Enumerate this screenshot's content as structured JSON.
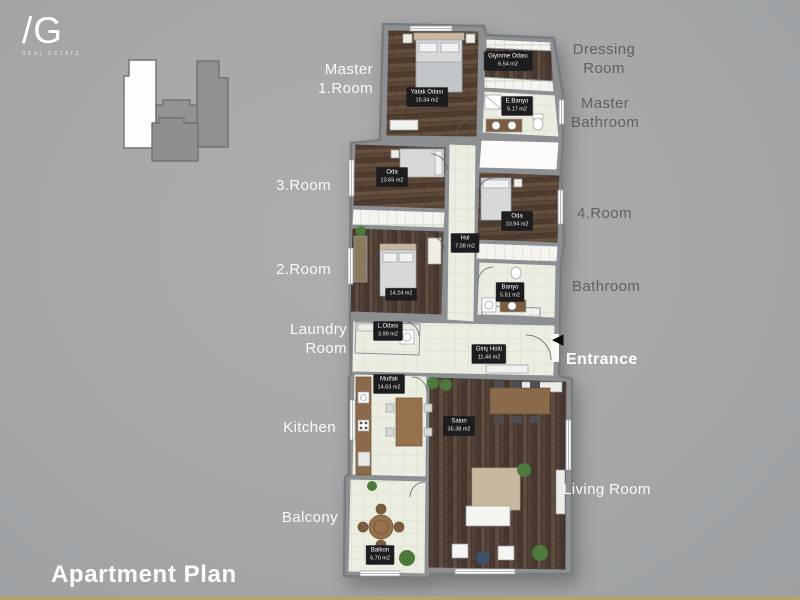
{
  "brand": {
    "mark": "/G",
    "subtitle": "REAL ESTATE"
  },
  "title": "Apartment Plan",
  "icons": {
    "entrance_arrow": "◀"
  },
  "outer_labels": {
    "master_room": {
      "line1": "Master",
      "line2": "1.Room"
    },
    "dressing": {
      "line1": "Dressing",
      "line2": "Room"
    },
    "master_bath": {
      "line1": "Master",
      "line2": "Bathroom"
    },
    "room3": {
      "label": "3.Room"
    },
    "room4": {
      "label": "4.Room"
    },
    "room2": {
      "label": "2.Room"
    },
    "bathroom": {
      "label": "Bathroom"
    },
    "laundry": {
      "line1": "Laundry",
      "line2": "Room"
    },
    "entrance": {
      "label": "Entrance"
    },
    "kitchen": {
      "label": "Kitchen"
    },
    "living": {
      "label": "Living Room"
    },
    "balcony": {
      "label": "Balcony"
    }
  },
  "plan": {
    "rooms": {
      "master": {
        "name": "Yatak Odası",
        "area": "15.34 m2"
      },
      "dressing": {
        "name": "Giyinme Odası",
        "area": "6.54 m2"
      },
      "master_bath": {
        "name": "E.Banyo",
        "area": "5.17 m2"
      },
      "room3": {
        "name": "Oda",
        "area": "13.65 m2"
      },
      "room4": {
        "name": "Oda",
        "area": "10.94 m2"
      },
      "hall": {
        "name": "Hol",
        "area": "7.08 m2"
      },
      "room2": {
        "area": "14.24 m2"
      },
      "bathroom": {
        "name": "Banyo",
        "area": "5.51 m2"
      },
      "laundry": {
        "name": "L.Odası",
        "area": "3.99 m2"
      },
      "entrance_hall": {
        "name": "Giriş Holü",
        "area": "11.44 m2"
      },
      "kitchen": {
        "name": "Mutfak",
        "area": "14.63 m2"
      },
      "living": {
        "name": "Salon",
        "area": "35.38 m2"
      },
      "balcony": {
        "name": "Balkon",
        "area": "6.70 m2"
      }
    }
  },
  "colors": {
    "background": "#a7a9ab",
    "wall": "#8d9093",
    "wood": "#5b4739",
    "tile": "#eaede0",
    "badge_bg": "#1d1d1f",
    "accent_strip": "#b3a372",
    "label_light": "#fafafa",
    "label_dark": "#5d6165"
  }
}
